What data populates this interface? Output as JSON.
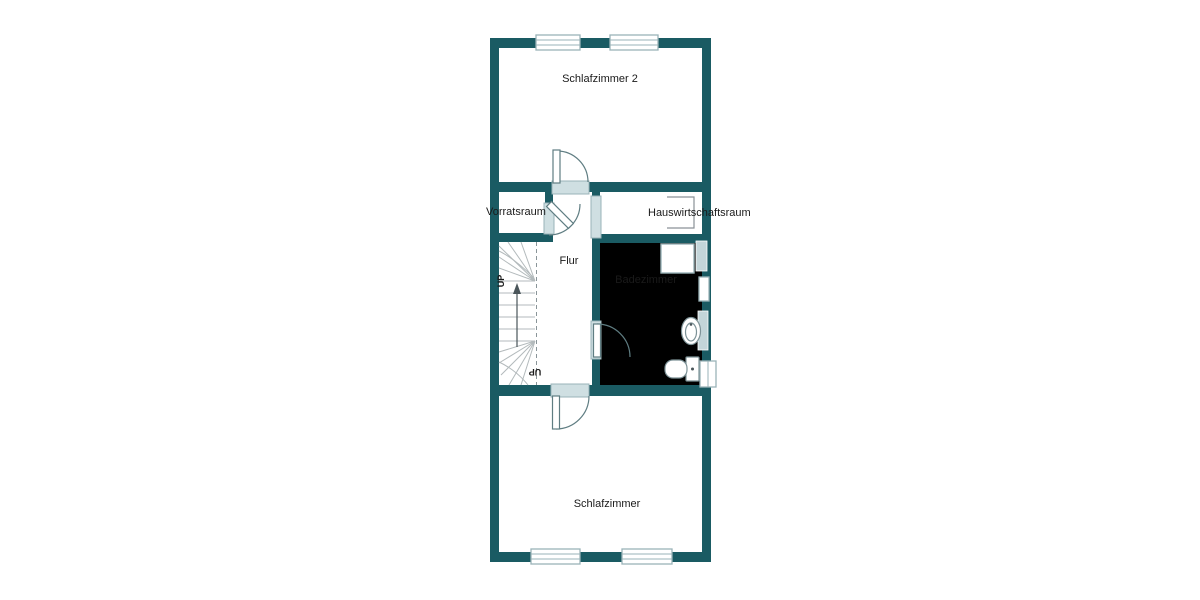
{
  "rooms": {
    "schlafzimmer2": "Schlafzimmer 2",
    "vorratsraum": "Vorratsraum",
    "hauswirtschaftsraum": "Hauswirtschaftsraum",
    "flur": "Flur",
    "badezimmer": "Badezimmer",
    "schlafzimmer": "Schlafzimmer"
  },
  "stairs": {
    "up_label": "UP",
    "down_label": "UP"
  },
  "colors": {
    "wall": "#1a5b63",
    "bath_fill": "#cdddе0",
    "frame": "#9ab3b8",
    "threshold": "#cfdfe2",
    "door": "#5f7d82",
    "tread": "#b3babc",
    "fixture": "#7d9297",
    "radiator": "#c3d5d9",
    "dash": "#8a9599",
    "arrow": "#4a555a",
    "text": "#1a1a1a"
  }
}
